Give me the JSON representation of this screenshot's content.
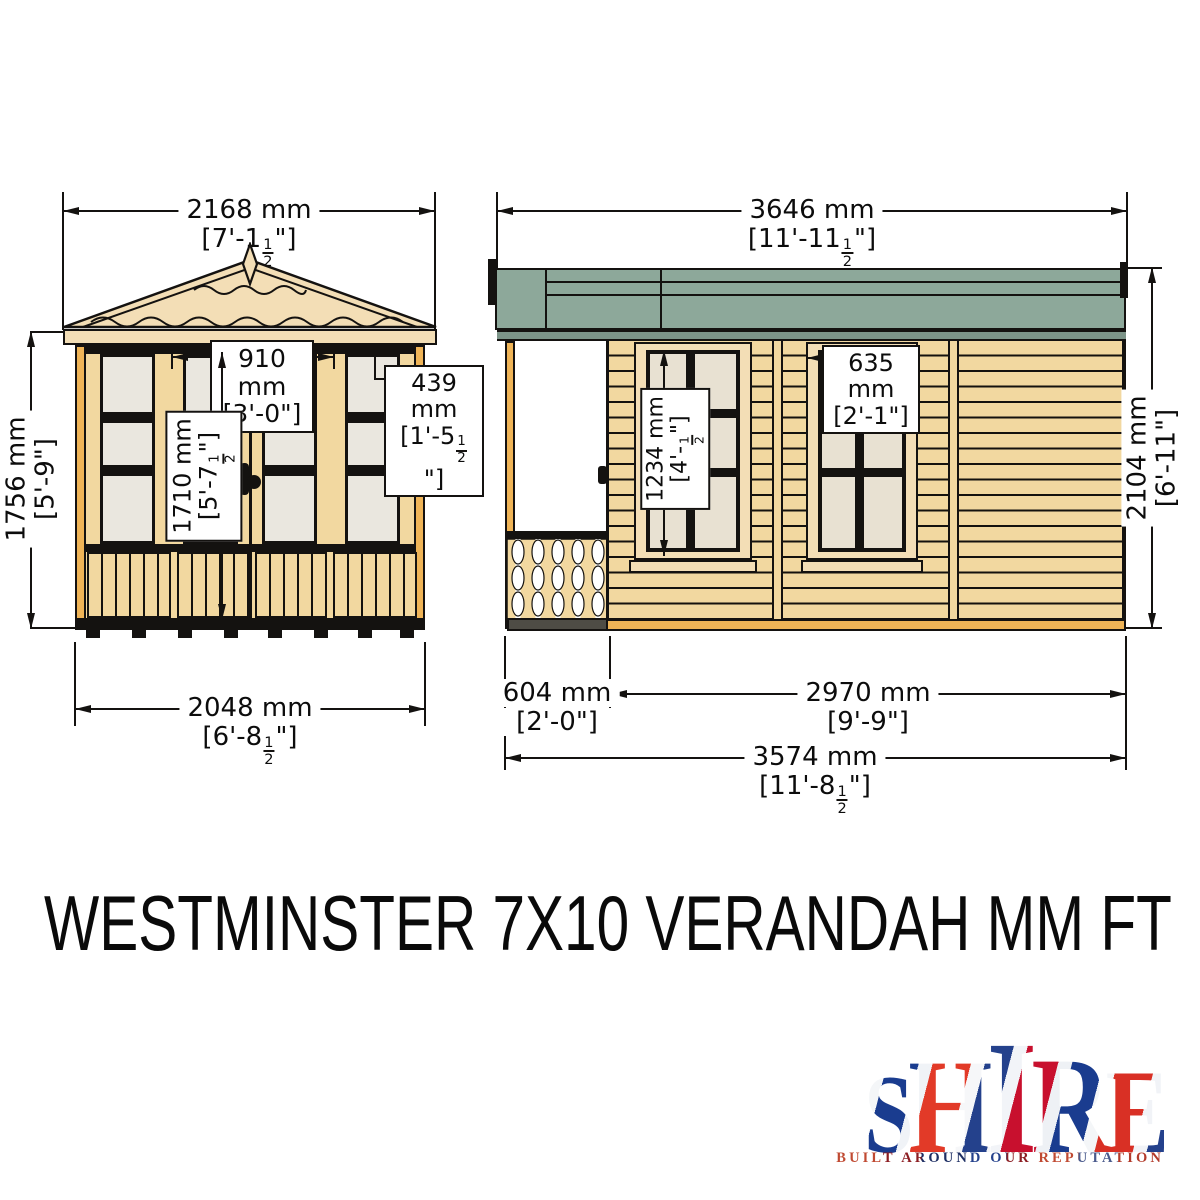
{
  "title": "WESTMINSTER 7X10 VERANDAH MM FT",
  "front_view": {
    "width_overall": {
      "mm": "2168 mm",
      "ft": "[7'-1½\"]"
    },
    "door_width": {
      "mm": "910 mm",
      "ft": "[3'-0\"]"
    },
    "side_window_width": {
      "mm": "439 mm",
      "ft": "[1'-5½\"]"
    },
    "door_height": {
      "mm": "1710 mm",
      "ft": "[5'-7½\"]"
    },
    "eaves_height": {
      "mm": "1756 mm",
      "ft": "[5'-9\"]"
    },
    "base_width": {
      "mm": "2048 mm",
      "ft": "[6'-8½\"]"
    }
  },
  "side_view": {
    "width_overall": {
      "mm": "3646 mm",
      "ft": "[11'-11½\"]"
    },
    "window_width": {
      "mm": "635 mm",
      "ft": "[2'-1\"]"
    },
    "window_height": {
      "mm": "1234 mm",
      "ft": "[4'-½\"]"
    },
    "wall_height": {
      "mm": "2104 mm",
      "ft": "[6'-11\"]"
    },
    "verandah_depth": {
      "mm": "604 mm",
      "ft": "[2'-0\"]"
    },
    "body_depth": {
      "mm": "2970 mm",
      "ft": "[9'-9\"]"
    },
    "base_depth": {
      "mm": "3574 mm",
      "ft": "[11'-8½\"]"
    }
  },
  "logo": {
    "brand": "SHIRE",
    "letters": [
      "S",
      "H",
      "I",
      "R",
      "E"
    ],
    "tagline": "BUILT AROUND OUR REPUTATION"
  },
  "colors": {
    "timber": "#f2d8a0",
    "timber_light": "#f3deb6",
    "trim_orange": "#efb457",
    "glass_front": "#eae7df",
    "glass_side": "#e8e1d2",
    "roof_green": "#8da89a",
    "roof_underside": "#7c9488",
    "line": "#141210"
  }
}
